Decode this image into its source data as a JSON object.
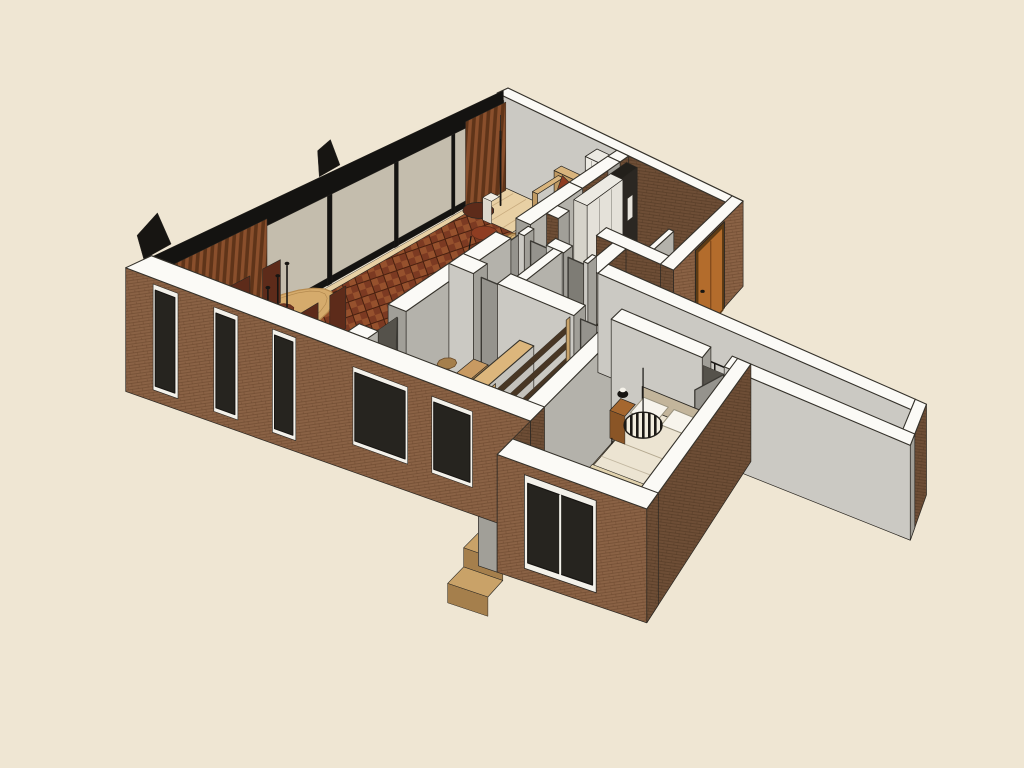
{
  "colors": {
    "background": "#efe6d3",
    "capWhite": "#fbfaf6",
    "edge": "#35322b",
    "faceEdge": "#2a2722",
    "brickLit": "#8a6245",
    "brickLitMortar": "#5a3a22",
    "brickShade": "#6e4e36",
    "brickShadeMortar": "#46301e",
    "grayFaceSouth": "#cbc9c3",
    "grayFaceEast": "#b4b2ab",
    "grayFaceEnd": "#a19f98",
    "glassTint": "#2f2e2a",
    "frameBlack": "#141311",
    "floorWood": "#e8d0a4",
    "floorWoodBedroom": "#e5c99b",
    "floorWoodCorridor": "#e2c697",
    "plankLine": "#8a6234",
    "floorGray": "#d7d5cf",
    "floorGrayRoom": "#c9c7c1",
    "floorCream": "#f0e9d8",
    "stairVoid": "#3a3126",
    "stairWood": "#c9a268",
    "stairRiser": "#a57f4c",
    "ladderWood": "#c9a36a",
    "ladderRung": "#483624",
    "woodCapHalf": "#dcb67c",
    "rugChevA": "#7c3a22",
    "rugChevB": "#96512d",
    "rugChevLine": "#48200f",
    "rugCream": "#eae0cb",
    "rugSpeck": "#a8916b",
    "sofaTan": "#d8b47d",
    "sofaTanDark": "#c09a63",
    "sofaTanSide": "#ab854f",
    "cushionRed": "#8e3d22",
    "cushionRed2": "#7a3a28",
    "tableWood": "#d5ab6c",
    "tableWoodDark": "#b68a4e",
    "chairRust": "#713622",
    "chairRustDark": "#5d2b1a",
    "deskWood": "#c89a62",
    "benchTan": "#d8b37c",
    "runnerTan": "#dcc094",
    "bedTop": "#ece4d2",
    "bedFront": "#dcd1ba",
    "bedSide": "#e2d7c1",
    "pillowWhite": "#f7f4ec",
    "headboard": "#c3b59b",
    "duvetLine": "#a69a80",
    "nightWood": "#a5672f",
    "pendantCream": "#f2edde",
    "pendantBlack": "#1d1a16",
    "frontDoor": "#b36c2c",
    "frontDoorDark": "#5c3a14",
    "doorGray": "#95938d",
    "doorGrayDark": "#7e7c75",
    "doorEdge": "#3b3934",
    "whiteCabinet": "#eceae3",
    "whiteCabinetSide": "#d6d3ca",
    "darkCabinet": "#2b2722",
    "black": "#171512",
    "curtainA": "#8a4f2c",
    "curtainB": "#5f3419",
    "tubWhite": "#f1f0ec",
    "tubInner": "#dededa"
  }
}
